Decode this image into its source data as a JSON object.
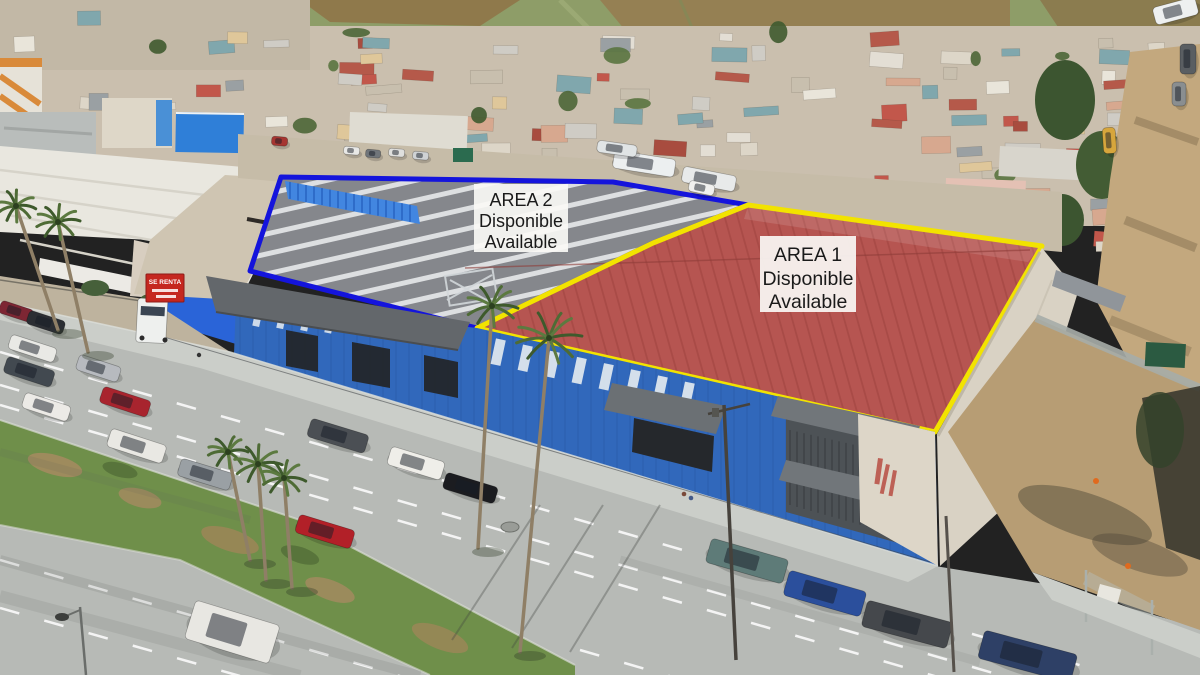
{
  "scene_labels": {
    "area2": {
      "title": "AREA 2",
      "subtitle_es": "Disponible",
      "subtitle_en": "Available",
      "outline_color": "#1414dc"
    },
    "area1": {
      "title": "AREA 1",
      "subtitle_es": "Disponible",
      "subtitle_en": "Available",
      "outline_color": "#f2e300"
    }
  },
  "signs": {
    "truck_banner": {
      "text": "SE RENTA",
      "bg_color": "#c5271f",
      "text_color": "#ffffff"
    }
  },
  "palette": {
    "red_roof": "#b65551",
    "gray_roof": "#85878c",
    "facade_blue": "#3168bb",
    "warehouse_white": "#e9e7df",
    "street_gray": "#b7bab6",
    "grass_green": "#6f8f4a",
    "dirt_tan": "#b79d74",
    "hill_green": "#8e9d68",
    "label_bg": "#faf8f5",
    "label_text": "#1a1a1a"
  }
}
